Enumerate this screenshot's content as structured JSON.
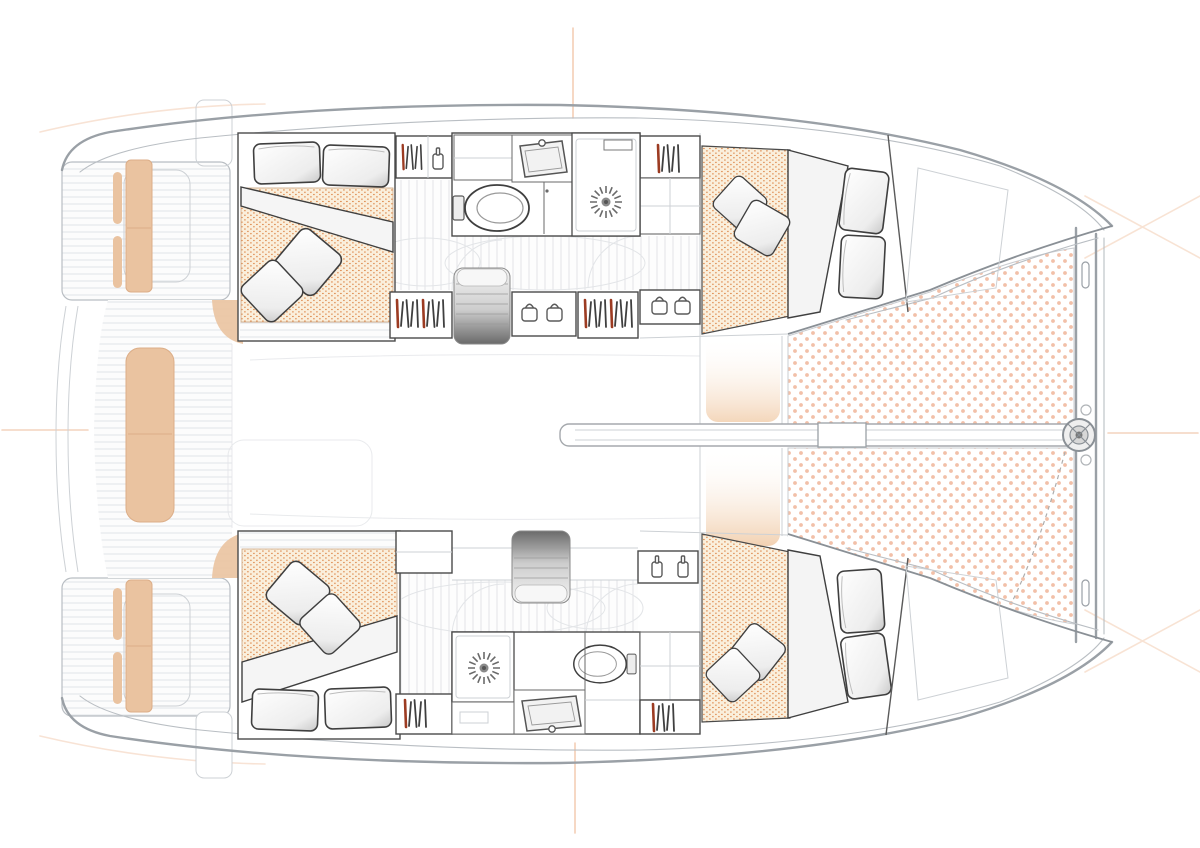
{
  "meta": {
    "title": "catamaran-interior-floorplan",
    "type": "floorplan",
    "view": "top-down"
  },
  "colors": {
    "background": "#ffffff",
    "hull_outline": "#9aa0a6",
    "hull_outline_light": "#b9bec3",
    "interior_wall": "#4a4a4a",
    "floor_plank": "#e1e3e6",
    "bed_dot": "#de8a4e",
    "bed_background": "#faefdc",
    "trampoline_dot": "#f2c0a8",
    "seat_tan": "#eac3a0",
    "seat_tan_edge": "#dcae88",
    "accent_mark": "#f0c2a2",
    "hanger_accent": "#9c3b22",
    "fixture_line": "#5a5a5a",
    "steps_dark": "#6a6a6a",
    "pillow_shade": "#d2d2d2"
  },
  "layout": {
    "hulls": [
      "port",
      "starboard"
    ],
    "cabins": [
      "port-aft",
      "port-forward",
      "starboard-aft",
      "starboard-forward"
    ],
    "wet_rooms": [
      "port-head",
      "starboard-head"
    ],
    "deck_zones": [
      "swim-platforms",
      "aft-cockpit",
      "saloon",
      "forward-cockpit",
      "trampoline",
      "bow-crossbeam"
    ]
  },
  "fixture_counts": {
    "double_beds": 4,
    "pillows": 8,
    "throw_cushions": 8,
    "toilets": 2,
    "showers": 2,
    "sinks": 2,
    "staircases": 2,
    "wardrobes": 7
  },
  "icons": [
    "pillow-icon",
    "cushion-icon",
    "duvet-fold",
    "mattress-dot-pattern",
    "hanging-clothes-icon",
    "bottle-icon",
    "jar-icon",
    "toilet-icon",
    "sink-icon",
    "faucet-icon",
    "shower-drain-icon",
    "staircase-icon",
    "rug-outline",
    "door-swing-arc",
    "trampoline-net-pattern",
    "bow-crossbeam",
    "bowsprit-spar",
    "anchor-fitting",
    "cockpit-bench-cushion",
    "swim-platform",
    "engine-hatch",
    "centerline-mark"
  ]
}
